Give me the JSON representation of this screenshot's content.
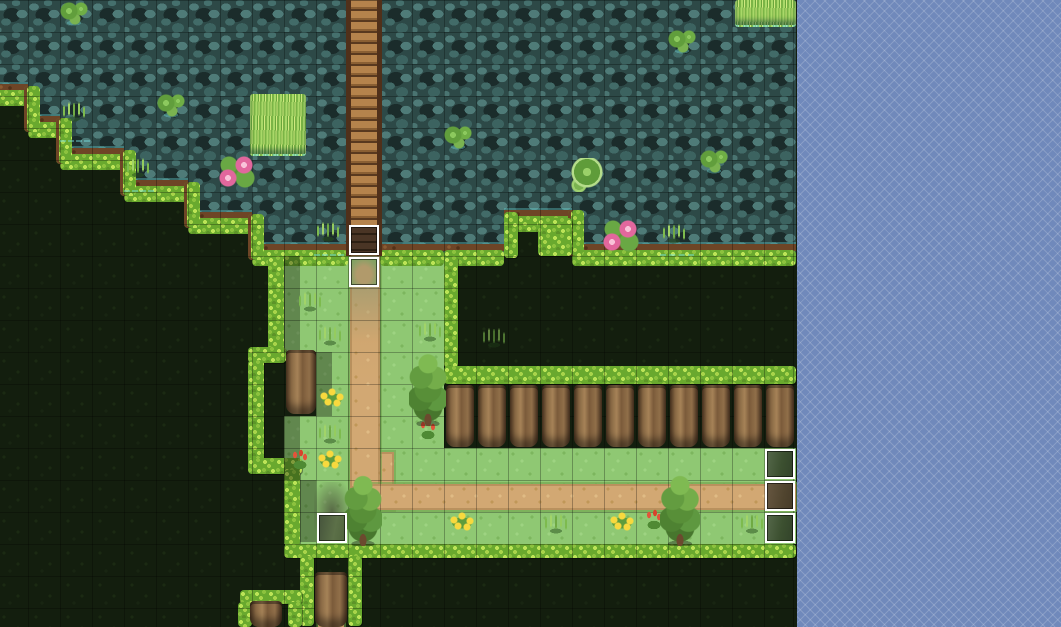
{
  "window": {
    "kind": "tile-map-editor-viewport",
    "map_area_width": 797,
    "map_area_height": 627
  },
  "palette": {
    "water_base": "#2d4947",
    "water_light": "#4f7b78",
    "water_dark": "#1b2c2b",
    "dark_grass": "#131e0e",
    "meadow": "#8fc873",
    "hedge": "#8cc23e",
    "hedge_light": "#bce457",
    "dirt_lip": "#6e4526",
    "path_tan": "#d2a873",
    "bridge_plank": "#b5834c",
    "trunk_brown": "#8a6a45",
    "tree_green": "#5e9840",
    "flower_yellow": "#f8d93e",
    "flower_red": "#e2543a",
    "lily_pink": "#e2679d",
    "waterline_cyan": "#78e1e1",
    "event_border": "#ffffff",
    "oob_base": "#7089bb",
    "oob_line": "#96a8d4"
  },
  "grid": {
    "tile_size": 32,
    "cols": 25,
    "rows": 20,
    "offset_x": -4,
    "offset_y": 0
  },
  "tilemap": {
    "legend": {
      "W": "water",
      "D": "dark-grass",
      "G": "grass",
      "P": "grass-path"
    },
    "rows": [
      "WWWWWWWWWWWWWWWWWWWWWWWWW",
      "WWWWWWWWWWWWWWWWWWWWWWWWW",
      "WWWWWWWWWWWWWWWWWWWWWWWWW",
      "DWWWWWWWWWWWWWWWWWWWWWWWW",
      "DDWWWWWWWWWWWWWWWWWWWWWWW",
      "DDDDWWWWWWWWWWWWWWWWWWWWW",
      "DDDDDDWWWWWWWWWWWWWWWWWWW",
      "DDDDDDDDWWWWWWWWDDWWWWWWW",
      "DDDDDDDDDGGPGGDDDDDDDDDDD",
      "DDDDDDDDDGGPGGDDDDDDDDDDD",
      "DDDDDDDDDGGPGGDDDDDDDDDDD",
      "DDDDDDDDDDGPGGDDDDDDDDDDD",
      "DDDDDDDDDDGPGGDDDDDDDDDDD",
      "DDDDDDDDDGGPGGDDDDDDDDDDD",
      "DDDDDDDDDGGPPGGGGGGGGGGGG",
      "DDDDDDDDDGGGPPPPPPPPPPPPP",
      "DDDDDDDDDGGGGGGGGGGGGGGGG",
      "DDDDDDDDDDDDDDDDDDDDDDDDD",
      "DDDDDDDDDDDDDDDDDDDDDDDDD",
      "DDDDDDDDDDDDDDDDDDDDDDDDD"
    ]
  },
  "overlays": {
    "lips": [
      {
        "x": -4,
        "y": 84,
        "w": 32
      },
      {
        "x": 28,
        "y": 116,
        "w": 32
      },
      {
        "x": 60,
        "y": 148,
        "w": 64
      },
      {
        "x": 124,
        "y": 180,
        "w": 64
      },
      {
        "x": 188,
        "y": 212,
        "w": 64
      },
      {
        "x": 252,
        "y": 244,
        "w": 96
      },
      {
        "x": 380,
        "y": 244,
        "w": 64
      },
      {
        "x": 444,
        "y": 244,
        "w": 60
      },
      {
        "x": 504,
        "y": 210,
        "w": 68
      },
      {
        "x": 572,
        "y": 244,
        "w": 224
      }
    ],
    "risers": [
      {
        "x": 24,
        "y": 86,
        "h": 46
      },
      {
        "x": 56,
        "y": 118,
        "h": 46
      },
      {
        "x": 120,
        "y": 150,
        "h": 46
      },
      {
        "x": 184,
        "y": 182,
        "h": 46
      },
      {
        "x": 248,
        "y": 214,
        "h": 46
      },
      {
        "x": 568,
        "y": 210,
        "h": 46
      }
    ],
    "hedges": [
      {
        "x": 268,
        "y": 256,
        "w": 16,
        "h": 98
      },
      {
        "x": 248,
        "y": 347,
        "w": 38,
        "h": 16
      },
      {
        "x": 248,
        "y": 360,
        "w": 16,
        "h": 104
      },
      {
        "x": 248,
        "y": 458,
        "w": 54,
        "h": 16
      },
      {
        "x": 284,
        "y": 470,
        "w": 16,
        "h": 76
      },
      {
        "x": 284,
        "y": 544,
        "w": 512,
        "h": 14
      },
      {
        "x": 444,
        "y": 256,
        "w": 14,
        "h": 112
      },
      {
        "x": 444,
        "y": 366,
        "w": 352,
        "h": 18
      },
      {
        "x": 300,
        "y": 556,
        "w": 14,
        "h": 70
      },
      {
        "x": 348,
        "y": 556,
        "w": 14,
        "h": 70
      },
      {
        "x": 240,
        "y": 590,
        "w": 62,
        "h": 14
      },
      {
        "x": 238,
        "y": 602,
        "w": 14,
        "h": 25
      },
      {
        "x": 288,
        "y": 602,
        "w": 14,
        "h": 25
      },
      {
        "x": 504,
        "y": 212,
        "w": 14,
        "h": 46
      },
      {
        "x": 538,
        "y": 218,
        "w": 34,
        "h": 38
      }
    ],
    "shadows": [
      {
        "x": 284,
        "y": 256,
        "w": 16,
        "h": 96
      },
      {
        "x": 316,
        "y": 352,
        "w": 16,
        "h": 64
      },
      {
        "x": 284,
        "y": 416,
        "w": 16,
        "h": 64
      },
      {
        "x": 300,
        "y": 480,
        "w": 16,
        "h": 62
      }
    ],
    "smudges": [
      {
        "x": 314,
        "y": 482,
        "w": 36,
        "h": 58
      }
    ],
    "paths": {
      "vertical": {
        "x": 350,
        "y": 252,
        "w": 30,
        "h": 236
      },
      "horizontal": {
        "x": 362,
        "y": 484,
        "w": 434,
        "h": 26
      },
      "elbow": {
        "x": 350,
        "y": 452,
        "w": 44,
        "h": 58
      },
      "stub": {
        "x": 318,
        "y": 600,
        "w": 26,
        "h": 27
      }
    },
    "bridge": {
      "x": 346,
      "y": 0,
      "w": 36,
      "h": 256
    }
  },
  "decor": [
    {
      "type": "lilypads",
      "x": 60,
      "y": 2,
      "w": 28,
      "h": 24
    },
    {
      "type": "lilypads",
      "x": 157,
      "y": 94,
      "w": 28,
      "h": 24
    },
    {
      "type": "lilypads",
      "x": 444,
      "y": 126,
      "w": 28,
      "h": 24
    },
    {
      "type": "lilypads",
      "x": 668,
      "y": 30,
      "w": 28,
      "h": 24
    },
    {
      "type": "lilypads",
      "x": 700,
      "y": 150,
      "w": 28,
      "h": 24
    },
    {
      "type": "lilypad-big",
      "x": 570,
      "y": 158,
      "w": 36,
      "h": 34
    },
    {
      "type": "lilies-pink",
      "x": 218,
      "y": 156,
      "w": 38,
      "h": 34
    },
    {
      "type": "lilies-pink",
      "x": 602,
      "y": 220,
      "w": 38,
      "h": 34
    },
    {
      "type": "grass-patch",
      "x": 250,
      "y": 94,
      "w": 56,
      "h": 60
    },
    {
      "type": "grass-overgrow",
      "x": 735,
      "y": 0,
      "w": 61,
      "h": 25
    },
    {
      "type": "tuft-water",
      "x": 60,
      "y": 100,
      "w": 30,
      "h": 40
    },
    {
      "type": "tuft-water",
      "x": 124,
      "y": 156,
      "w": 30,
      "h": 34
    },
    {
      "type": "tuft-water",
      "x": 314,
      "y": 220,
      "w": 30,
      "h": 34
    },
    {
      "type": "tuft-water",
      "x": 660,
      "y": 222,
      "w": 34,
      "h": 32
    },
    {
      "type": "tuft",
      "x": 296,
      "y": 290,
      "w": 28,
      "h": 26
    },
    {
      "type": "tuft",
      "x": 316,
      "y": 324,
      "w": 28,
      "h": 26
    },
    {
      "type": "tuft",
      "x": 316,
      "y": 422,
      "w": 28,
      "h": 26
    },
    {
      "type": "tuft",
      "x": 416,
      "y": 320,
      "w": 28,
      "h": 26
    },
    {
      "type": "tuft-dim",
      "x": 480,
      "y": 326,
      "w": 30,
      "h": 28
    },
    {
      "type": "tuft",
      "x": 542,
      "y": 512,
      "w": 28,
      "h": 26
    },
    {
      "type": "tuft",
      "x": 738,
      "y": 512,
      "w": 28,
      "h": 26
    },
    {
      "type": "flowers-yellow",
      "x": 316,
      "y": 388,
      "w": 32,
      "h": 20
    },
    {
      "type": "flowers-yellow",
      "x": 314,
      "y": 450,
      "w": 32,
      "h": 20
    },
    {
      "type": "flowers-yellow",
      "x": 446,
      "y": 512,
      "w": 32,
      "h": 20
    },
    {
      "type": "flowers-yellow",
      "x": 606,
      "y": 512,
      "w": 32,
      "h": 20
    },
    {
      "type": "flowers-red",
      "x": 290,
      "y": 448,
      "w": 20,
      "h": 24
    },
    {
      "type": "flowers-red",
      "x": 418,
      "y": 418,
      "w": 20,
      "h": 24
    },
    {
      "type": "flowers-red",
      "x": 644,
      "y": 508,
      "w": 20,
      "h": 26
    },
    {
      "type": "tree",
      "x": 409,
      "y": 352,
      "w": 38,
      "h": 74
    },
    {
      "type": "tree",
      "x": 344,
      "y": 474,
      "w": 38,
      "h": 72
    },
    {
      "type": "tree",
      "x": 660,
      "y": 474,
      "w": 40,
      "h": 72
    },
    {
      "type": "trunk",
      "x": 286,
      "y": 350,
      "w": 30,
      "h": 64
    },
    {
      "type": "trunk",
      "x": 446,
      "y": 385,
      "w": 28,
      "h": 62
    },
    {
      "type": "trunk",
      "x": 478,
      "y": 385,
      "w": 28,
      "h": 62
    },
    {
      "type": "trunk",
      "x": 510,
      "y": 385,
      "w": 28,
      "h": 62
    },
    {
      "type": "trunk",
      "x": 542,
      "y": 385,
      "w": 28,
      "h": 62
    },
    {
      "type": "trunk",
      "x": 574,
      "y": 385,
      "w": 28,
      "h": 62
    },
    {
      "type": "trunk",
      "x": 606,
      "y": 385,
      "w": 28,
      "h": 62
    },
    {
      "type": "trunk",
      "x": 638,
      "y": 385,
      "w": 28,
      "h": 62
    },
    {
      "type": "trunk",
      "x": 670,
      "y": 385,
      "w": 28,
      "h": 62
    },
    {
      "type": "trunk",
      "x": 702,
      "y": 385,
      "w": 28,
      "h": 62
    },
    {
      "type": "trunk",
      "x": 734,
      "y": 385,
      "w": 28,
      "h": 62
    },
    {
      "type": "trunk",
      "x": 766,
      "y": 385,
      "w": 28,
      "h": 62
    },
    {
      "type": "trunk",
      "x": 315,
      "y": 572,
      "w": 32,
      "h": 55
    },
    {
      "type": "trunk",
      "x": 250,
      "y": 601,
      "w": 32,
      "h": 26
    }
  ],
  "events": [
    {
      "x": 348,
      "y": 224,
      "kind": "bridge-dark"
    },
    {
      "x": 348,
      "y": 256,
      "kind": "path-grass"
    },
    {
      "x": 316,
      "y": 512,
      "kind": "shade-grey"
    },
    {
      "x": 764,
      "y": 448,
      "kind": "shade-green"
    },
    {
      "x": 764,
      "y": 480,
      "kind": "shade-brown"
    },
    {
      "x": 764,
      "y": 512,
      "kind": "shade-green"
    }
  ],
  "oob": {
    "x": 797,
    "w": 264,
    "pattern": "diagonal-lattice",
    "period_px": 7
  }
}
